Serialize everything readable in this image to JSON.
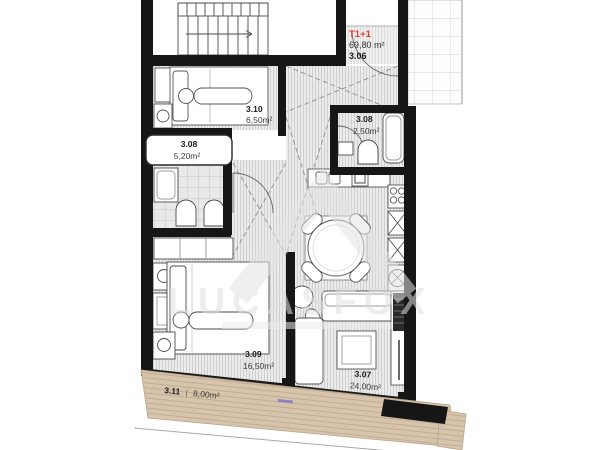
{
  "plan": {
    "unit_label": {
      "type": "T1+1",
      "area": "69,80 m²",
      "number": "3.06"
    },
    "rooms": [
      {
        "number": "3.10",
        "area": "6,50m²"
      },
      {
        "number": "3.08",
        "area": "5,20m²"
      },
      {
        "number": "3.08",
        "area": "2,50m²"
      },
      {
        "number": "3.09",
        "area": "16,50m²"
      },
      {
        "number": "3.07",
        "area": "24,00m²"
      },
      {
        "number": "3.11",
        "separator": "|",
        "area": "8,00m²"
      }
    ],
    "watermark": {
      "text": "LUCASFOX"
    },
    "colors": {
      "wall": "#161616",
      "unit_type_accent": "#e23b2e",
      "terrace_deck": "#d6c4ad",
      "floor_hatch": "#ebebeb"
    }
  }
}
